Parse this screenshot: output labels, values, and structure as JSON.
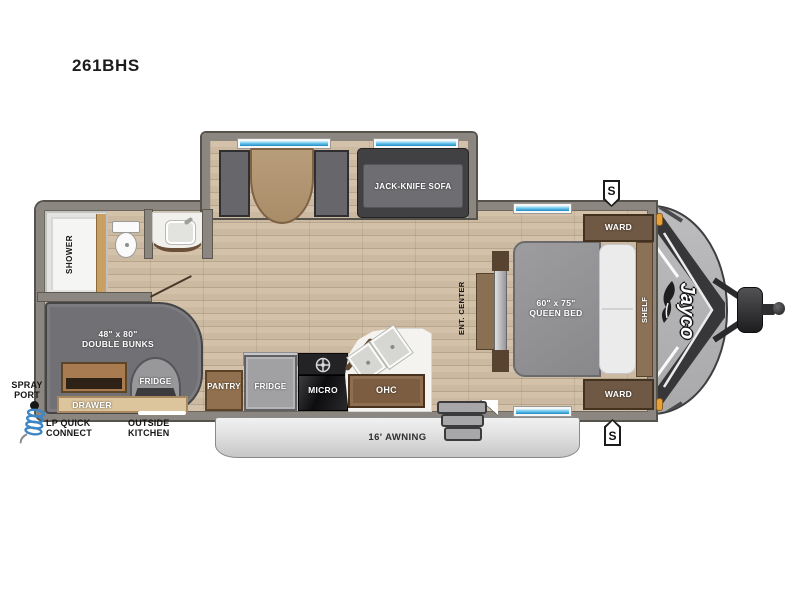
{
  "title": {
    "model": "261BHS"
  },
  "labels": {
    "sofa": "JACK-KNIFE SOFA",
    "shower": "SHOWER",
    "bunks_size": "48\" x 80\"",
    "bunks_name": "DOUBLE BUNKS",
    "outside_fridge": "FRIDGE",
    "drawer": "DRAWER",
    "pantry": "PANTRY",
    "fridge": "FRIDGE",
    "micro": "MICRO",
    "ohc": "OHC",
    "bed_size": "60\" x 75\"",
    "bed_name": "QUEEN BED",
    "ward_top": "WARD",
    "ward_bottom": "WARD",
    "shelf": "SHELF",
    "ent_center": "ENT. CENTER",
    "awning": "16' AWNING",
    "spray_line1": "SPRAY",
    "spray_line2": "PORT",
    "lp_line1": "LP QUICK",
    "lp_line2": "CONNECT",
    "outside_kitchen_line1": "OUTSIDE",
    "outside_kitchen_line2": "KITCHEN",
    "brand": "Jayco",
    "badge_top": "S",
    "badge_bottom": "S"
  },
  "colors": {
    "wall_gray": "#8b8680",
    "floor_wood": "#ccb9a1",
    "window_blue": "#2f9fd6",
    "bunk_gray": "#707074",
    "cabinet_brown": "#6f5844",
    "cap_gray": "#b5b5b7",
    "awning_gray": "#d9d9d9",
    "marker_amber": "#e6a23a",
    "coil_blue": "#3f86c6"
  }
}
